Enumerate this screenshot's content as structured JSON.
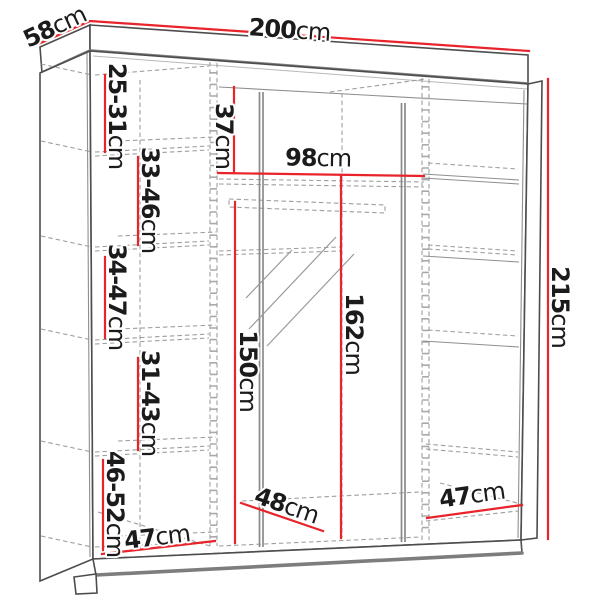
{
  "diagram": {
    "type": "wardrobe-dimension-drawing",
    "unit": "cm",
    "colors": {
      "dimension_line": "#e8232a",
      "outline": "#4d4d4d",
      "dashed": "#9e9e9e",
      "text": "#1b1b1b",
      "background": "#ffffff"
    },
    "overall": {
      "width": {
        "value": "200",
        "unit": "cm"
      },
      "depth": {
        "value": "58",
        "unit": "cm"
      },
      "height": {
        "value": "215",
        "unit": "cm"
      }
    },
    "left_column_gaps": [
      {
        "value": "25-31",
        "unit": "cm"
      },
      {
        "value": "33-46",
        "unit": "cm"
      },
      {
        "value": "34-47",
        "unit": "cm"
      },
      {
        "value": "31-43",
        "unit": "cm"
      },
      {
        "value": "46-52",
        "unit": "cm"
      }
    ],
    "middle_section": {
      "top_gap": {
        "value": "37",
        "unit": "cm"
      },
      "width": {
        "value": "98",
        "unit": "cm"
      },
      "hanging_height": {
        "value": "150",
        "unit": "cm"
      },
      "open_height": {
        "value": "162",
        "unit": "cm"
      },
      "floor_depth": {
        "value": "48",
        "unit": "cm"
      }
    },
    "left_section_width": {
      "value": "47",
      "unit": "cm"
    },
    "right_section_width": {
      "value": "47",
      "unit": "cm"
    }
  }
}
